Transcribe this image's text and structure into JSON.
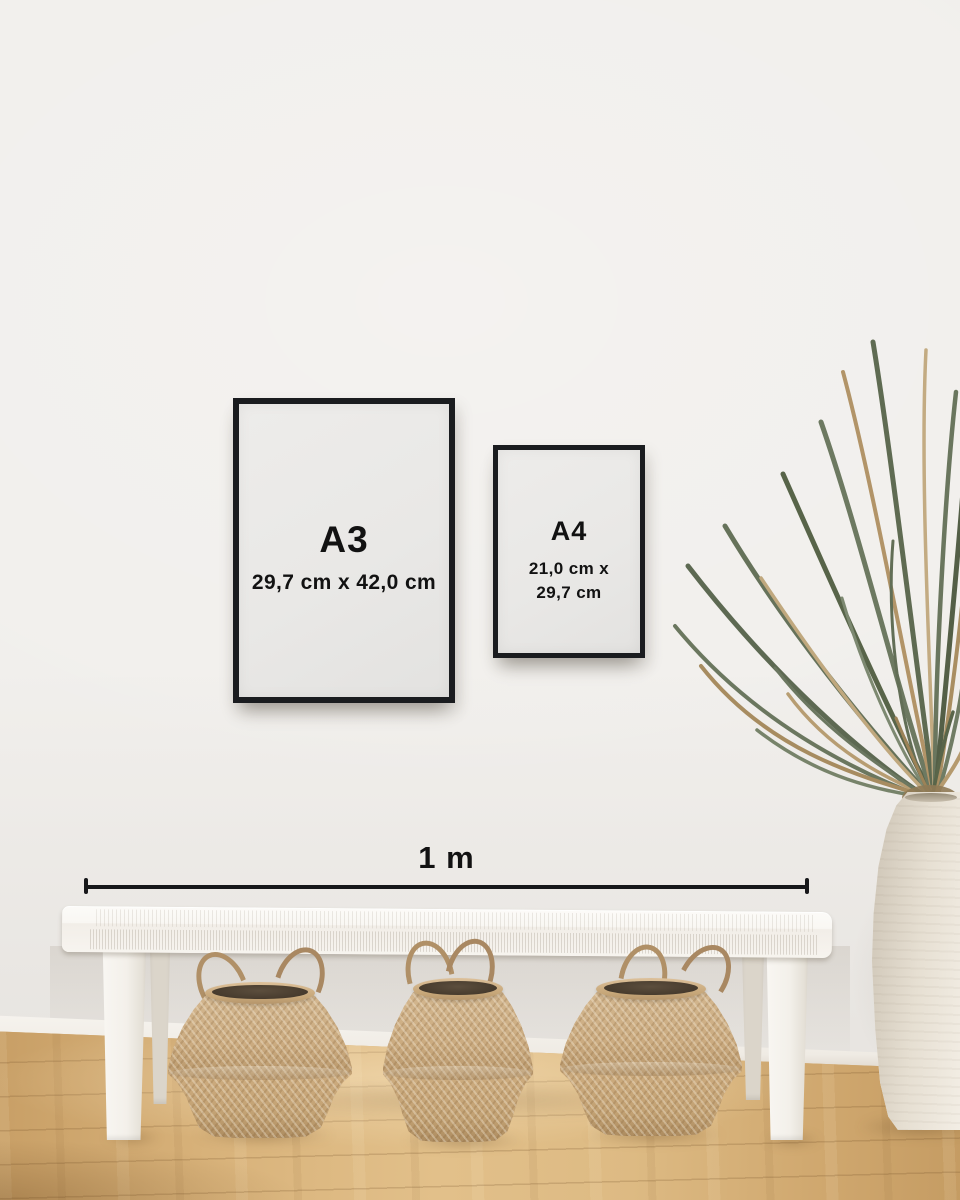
{
  "frames": {
    "a3": {
      "label": "A3",
      "dimensions": "29,7 cm x 42,0 cm"
    },
    "a4": {
      "label": "A4",
      "dimensions_line1": "21,0 cm x",
      "dimensions_line2": "29,7 cm"
    }
  },
  "scale_bar": {
    "label": "1 m"
  },
  "colors": {
    "frame-border": "#1a1c1f",
    "label-text": "#121212",
    "scale-line": "#17181a",
    "wall": "#f1efec",
    "floor": "#d4ac74",
    "bench": "#f7f5f1",
    "basket": "#c7a77b",
    "vase": "#ece6da",
    "plant-green": "#68745c",
    "plant-tan": "#b0976c"
  }
}
